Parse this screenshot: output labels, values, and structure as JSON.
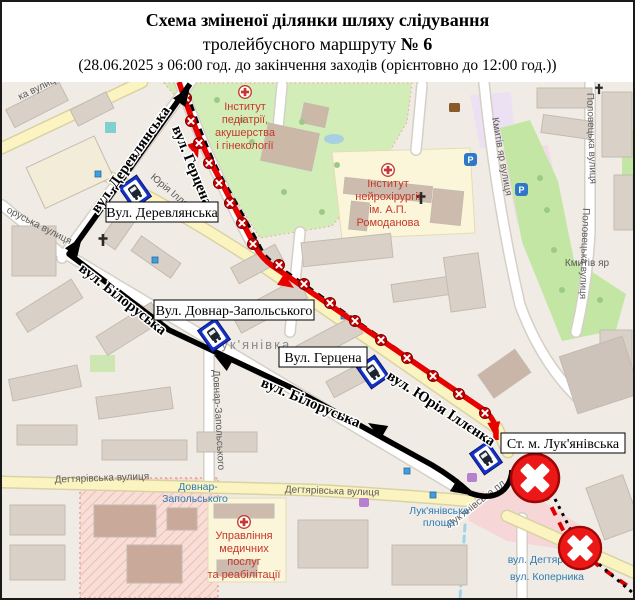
{
  "title": {
    "line1": "Схема зміненої ділянки шляху слідування",
    "line2_prefix": "тролейбусного маршруту ",
    "line2_route_no": "№ 6",
    "line3": "(28.06.2025 з 06:00 год. до закінчення заходів (орієнтовно до 12:00 год.))"
  },
  "route": {
    "number": "6",
    "closed_section_color": "#e60000",
    "detour_color": "#000000",
    "closure_marker_color": "#c80000"
  },
  "stops": [
    {
      "label": "Вул. Деревлянська"
    },
    {
      "label": "Вул. Довнар-Запольського"
    },
    {
      "label": "Вул. Герцена"
    },
    {
      "label": "Ст. м. Лук'янівська"
    }
  ],
  "street_labels": {
    "derevlianska": "вул. Деревлянська",
    "hertsena": "вул. Герцена",
    "biloruska_upper": "вул. Білоруська",
    "biloruska_lower": "вул. Білоруська",
    "illienka": "вул. Юрія Іллєнка"
  },
  "map_labels": {
    "neighborhood": "Лук'янівка",
    "kmytiv_yar": "Кмитів яр",
    "dehtiarivska_1": "Дегтярівська вулиця",
    "dehtiarivska_2": "Дегтярівська вулиця",
    "kmytiv_yar_street": "Кмитів яр вулиця",
    "polovetska_1": "Половецька вулиця",
    "polovetska_2": "Половецька вулиця",
    "illienka_small": "Юрія Іллєнка",
    "dovnar_street": "Довнар-Запольського",
    "lukianivska_pl": "Лук'янівська пл",
    "top_left_street": "ка вулиця",
    "left_street": "оруська вулиця",
    "parking": "P"
  },
  "transit_labels": {
    "dovnar_line1": "Довнар-",
    "dovnar_line2": "Запольського",
    "luk_square_line1": "Лук'янівська",
    "luk_square_line2": "площа",
    "dehtiarivska_stop": "вул. Дегтярівська",
    "kopernyka_stop": "вул. Коперника"
  },
  "poi": {
    "pediatrics": [
      "Інститут",
      "педіатрії,",
      "акушерства",
      "і гінекології"
    ],
    "neurosurgery": [
      "Інститут",
      "нейрохірургії",
      "ім. А.П.",
      "Ромоданова"
    ],
    "medservice": [
      "Управління",
      "медичних",
      "послуг",
      "та реабілітації"
    ]
  }
}
